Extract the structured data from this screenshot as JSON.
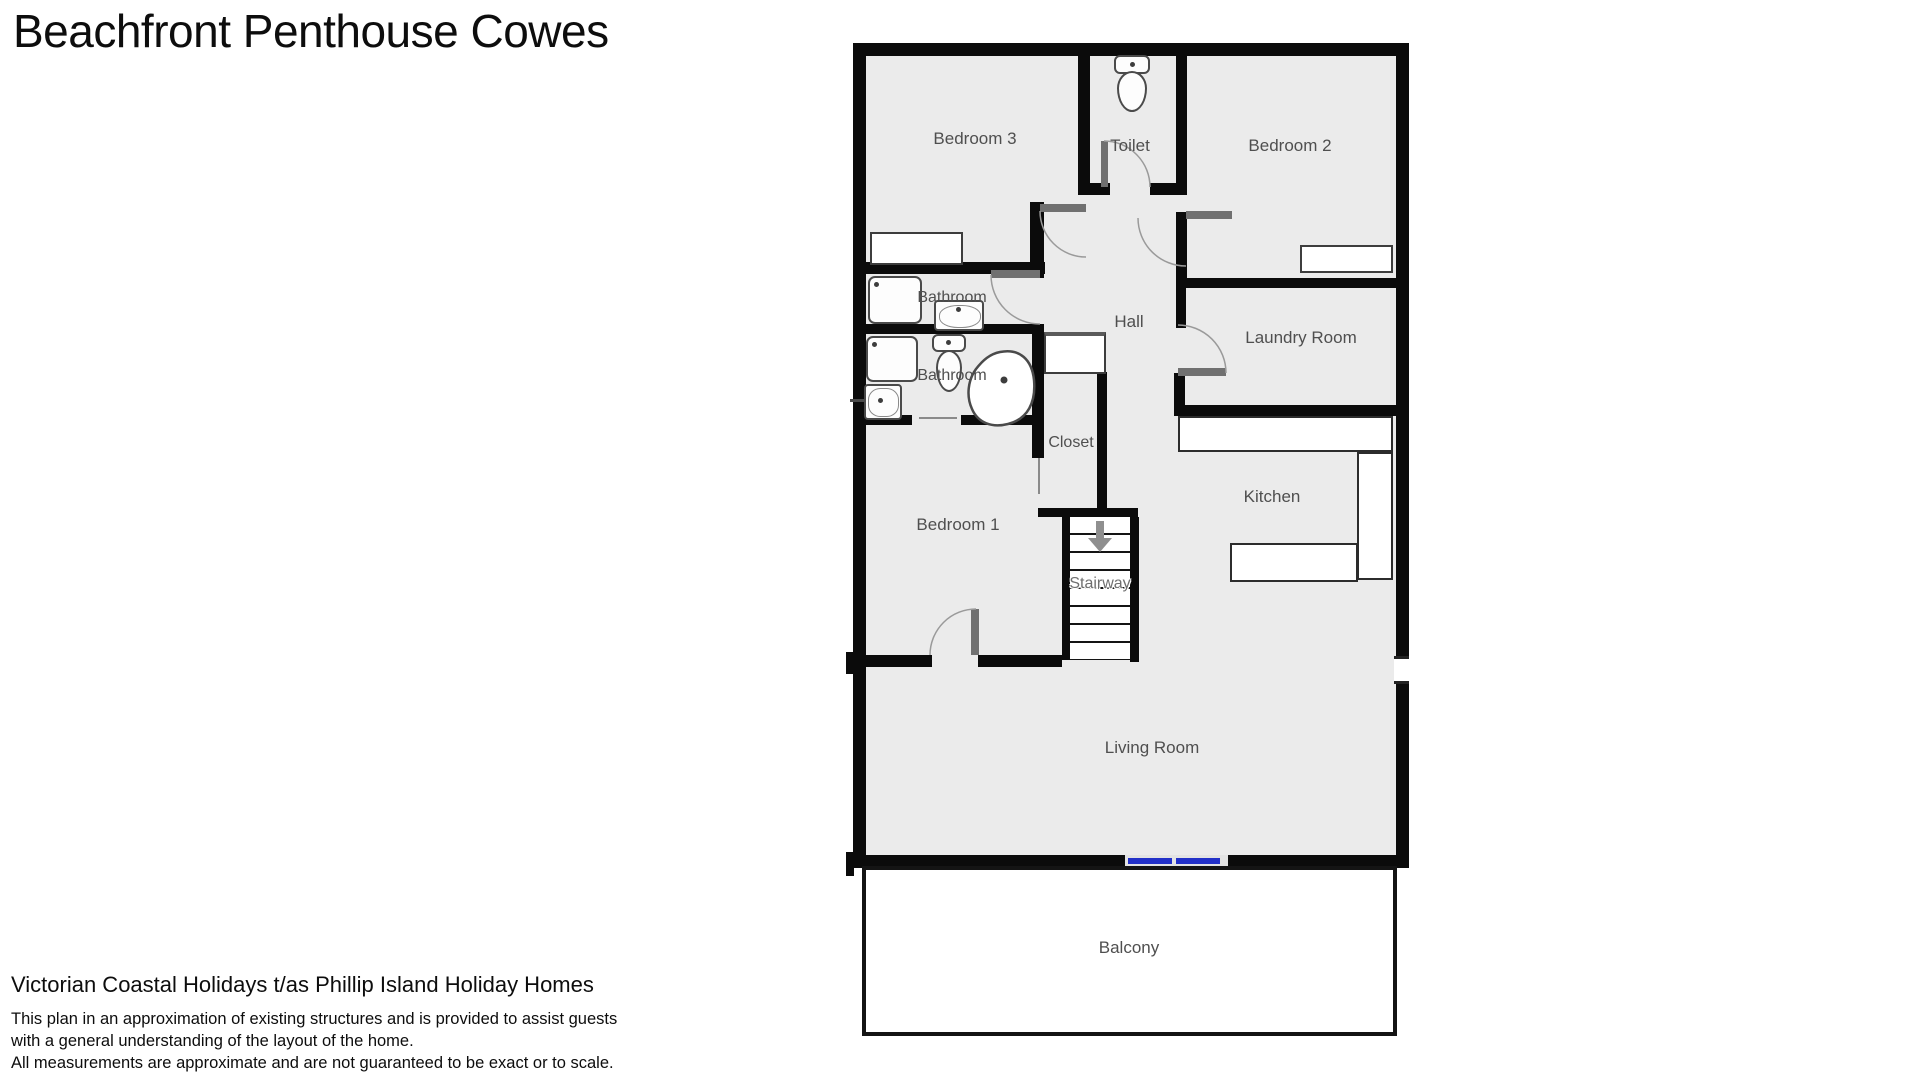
{
  "title": "Beachfront Penthouse Cowes",
  "rooms": {
    "bedroom3": "Bedroom 3",
    "toilet": "Toilet",
    "bedroom2": "Bedroom 2",
    "bathroom1": "Bathroom",
    "bathroom2": "Bathroom",
    "hall": "Hall",
    "laundry": "Laundry Room",
    "closet": "Closet",
    "kitchen": "Kitchen",
    "bedroom1": "Bedroom 1",
    "stairway": "Stairway",
    "living": "Living Room",
    "balcony": "Balcony"
  },
  "colors": {
    "wall": "#0b0b0b",
    "floor": "#ebebeb",
    "sliding_door": "#2230c8",
    "label": "#4f4f4f"
  },
  "footer": {
    "heading": "Victorian Coastal Holidays t/as Phillip Island Holiday Homes",
    "line1": "This plan in an approximation of existing structures and is provided to assist guests",
    "line2": "with a general understanding of the layout of the home.",
    "line3": "All measurements are approximate and are not guaranteed to be exact or to scale."
  }
}
